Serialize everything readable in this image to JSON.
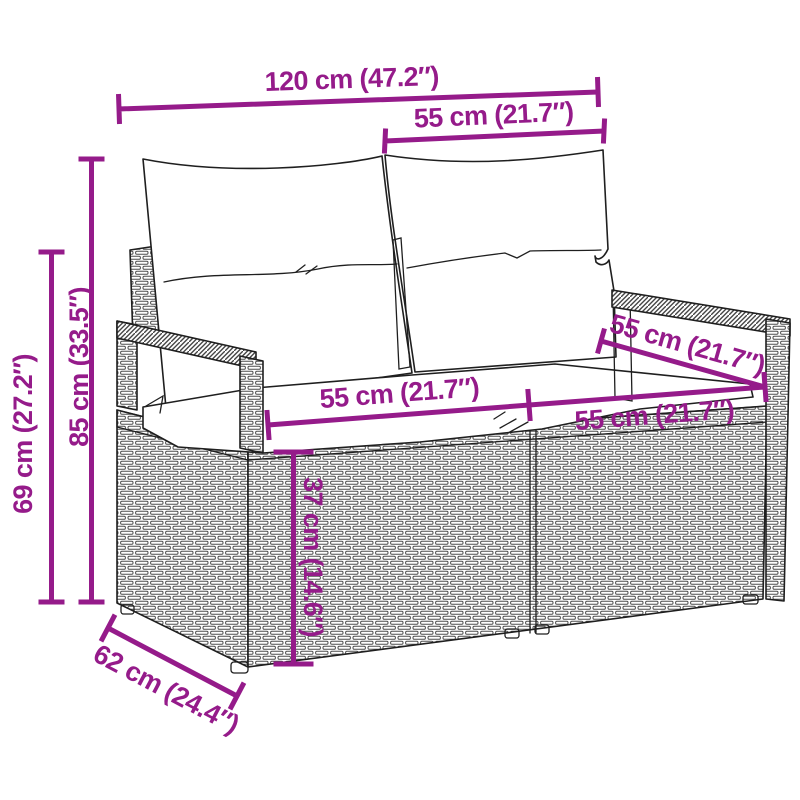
{
  "page": {
    "title": "Garden sofa dimension diagram",
    "background_color": "#ffffff"
  },
  "diagram": {
    "subject": "2-seater poly rattan garden sofa with back and seat cushions",
    "accent_color": "#951B8A",
    "line_color": "#1f1f1f",
    "dimensions": {
      "total_width": "120 cm (47.2″)",
      "back_cushion_width": "55 cm (21.7″)",
      "total_height": "85 cm (33.5″)",
      "armrest_height": "69 cm (27.2″)",
      "seat_width_left": "55 cm (21.7″)",
      "seat_width_right": "55 cm (21.7″)",
      "seat_depth": "55 cm (21.7″)",
      "seat_height": "37 cm (14.6″)",
      "base_depth": "62 cm (24.4″)"
    }
  }
}
